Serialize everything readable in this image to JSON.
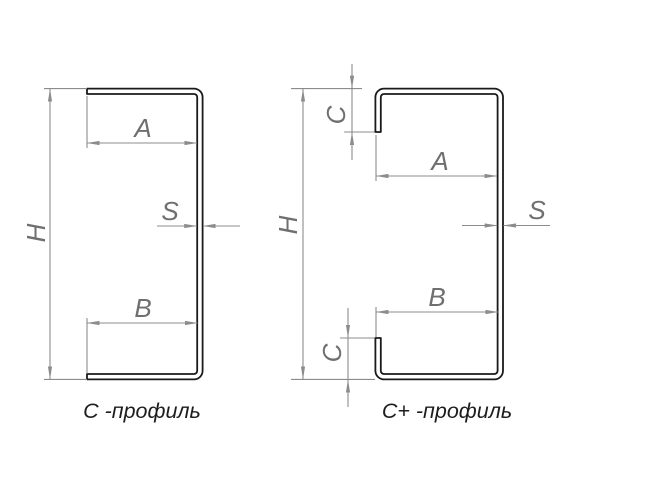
{
  "diagram": {
    "background_color": "#ffffff",
    "colors": {
      "profile_outline": "#1a1a1a",
      "dimension_lines": "#8c8c8c",
      "dimension_text": "#6f6f6f",
      "caption_text": "#1d1d1d"
    },
    "left_profile": {
      "caption": "C -профиль",
      "dimensions": {
        "height": "H",
        "top_flange_width": "A",
        "bottom_flange_width": "B",
        "thickness": "S"
      }
    },
    "right_profile": {
      "caption": "C+ -профиль",
      "dimensions": {
        "height": "H",
        "top_flange_width": "A",
        "bottom_flange_width": "B",
        "thickness": "S",
        "top_lip": "C",
        "bottom_lip": "C"
      }
    }
  }
}
